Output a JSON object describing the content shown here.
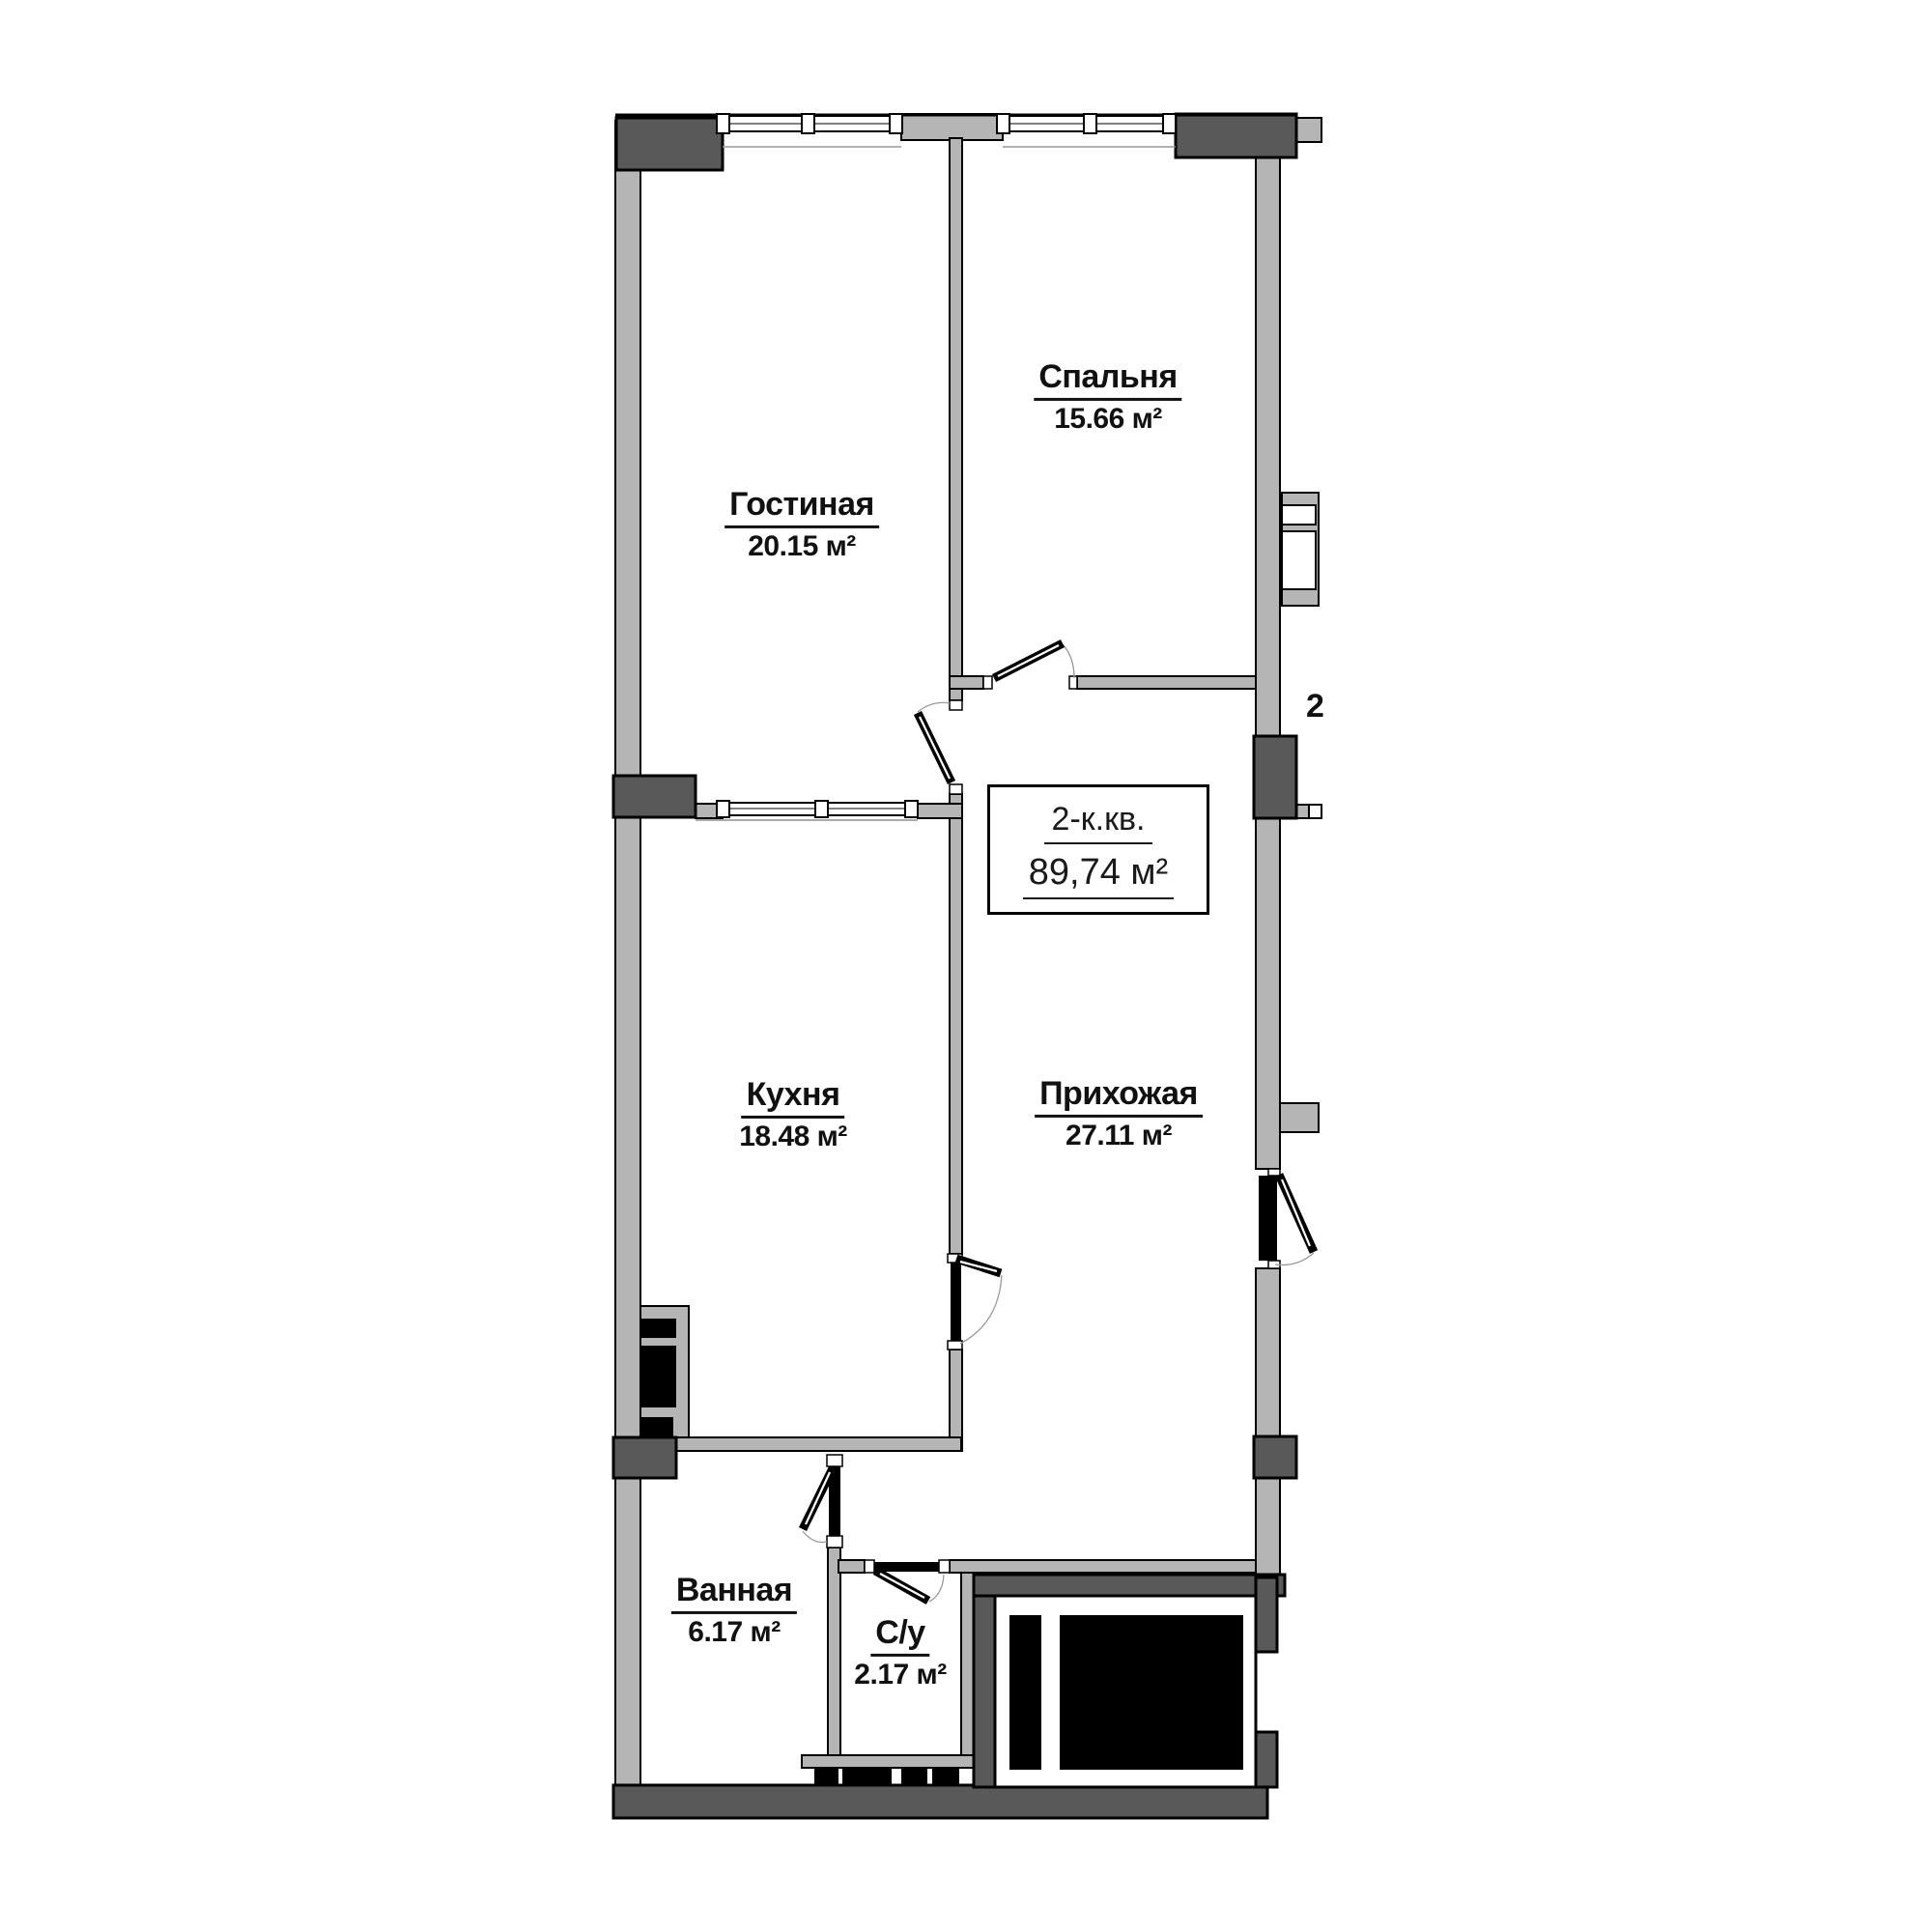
{
  "plan": {
    "unit": {
      "type": "2-к.кв.",
      "area": "89,74 м²"
    },
    "rooms": [
      {
        "id": "living",
        "name": "Гостиная",
        "area": "20.15 м²"
      },
      {
        "id": "bedroom",
        "name": "Спальня",
        "area": "15.66 м²"
      },
      {
        "id": "kitchen",
        "name": "Кухня",
        "area": "18.48 м²"
      },
      {
        "id": "hallway",
        "name": "Прихожая",
        "area": "27.11 м²"
      },
      {
        "id": "bathroom",
        "name": "Ванная",
        "area": "6.17 м²"
      },
      {
        "id": "wc",
        "name": "С/у",
        "area": "2.17 м²"
      }
    ],
    "clipped_neighbor_text": "2",
    "colors": {
      "wall_light": "#b5b5b5",
      "wall_dark": "#595959",
      "shaft": "#000000",
      "line": "#000000",
      "background": "#ffffff"
    }
  }
}
